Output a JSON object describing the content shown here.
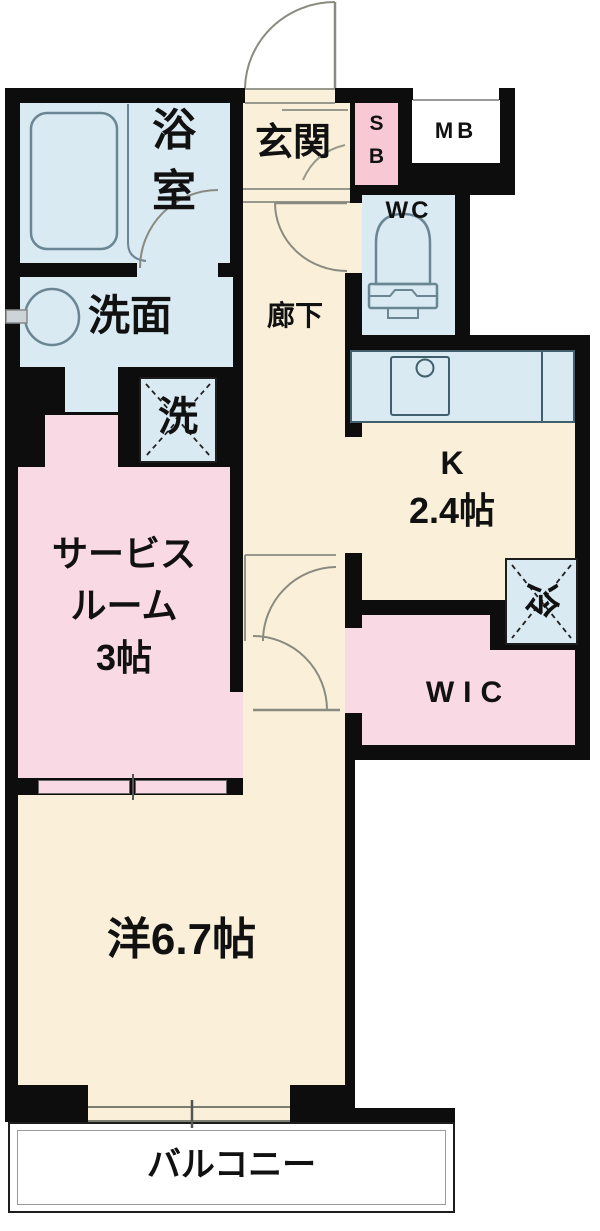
{
  "palette": {
    "wall": "#0d0d0d",
    "floor_cream": "#faf0da",
    "wet_area_blue": "#d9eaf3",
    "room_pink": "#f9d9e3",
    "shoebox_pink": "#f8c9d4",
    "outside_white": "#ffffff",
    "fixture_stroke": "#6b8693",
    "door_stroke": "#8a8a80"
  },
  "rooms": {
    "bathroom": {
      "label": "浴室",
      "lines": [
        "浴",
        "室"
      ]
    },
    "entrance": {
      "label": "玄関"
    },
    "shoe_box": {
      "label": "SB",
      "lines": [
        "S",
        "B"
      ]
    },
    "meter_box": {
      "label": "MB"
    },
    "toilet": {
      "label": "WC"
    },
    "washroom": {
      "label": "洗面"
    },
    "laundry": {
      "label": "洗"
    },
    "hallway": {
      "label": "廊下"
    },
    "kitchen": {
      "label": "K",
      "size": "2.4帖"
    },
    "refrigerator": {
      "label": "冷"
    },
    "wic": {
      "label": "WIC"
    },
    "service_room": {
      "label": "サービスルーム 3帖",
      "lines": [
        "サービス",
        "ルーム",
        "3帖"
      ]
    },
    "western_room": {
      "label": "洋6.7帖"
    },
    "balcony": {
      "label": "バルコニー"
    }
  }
}
